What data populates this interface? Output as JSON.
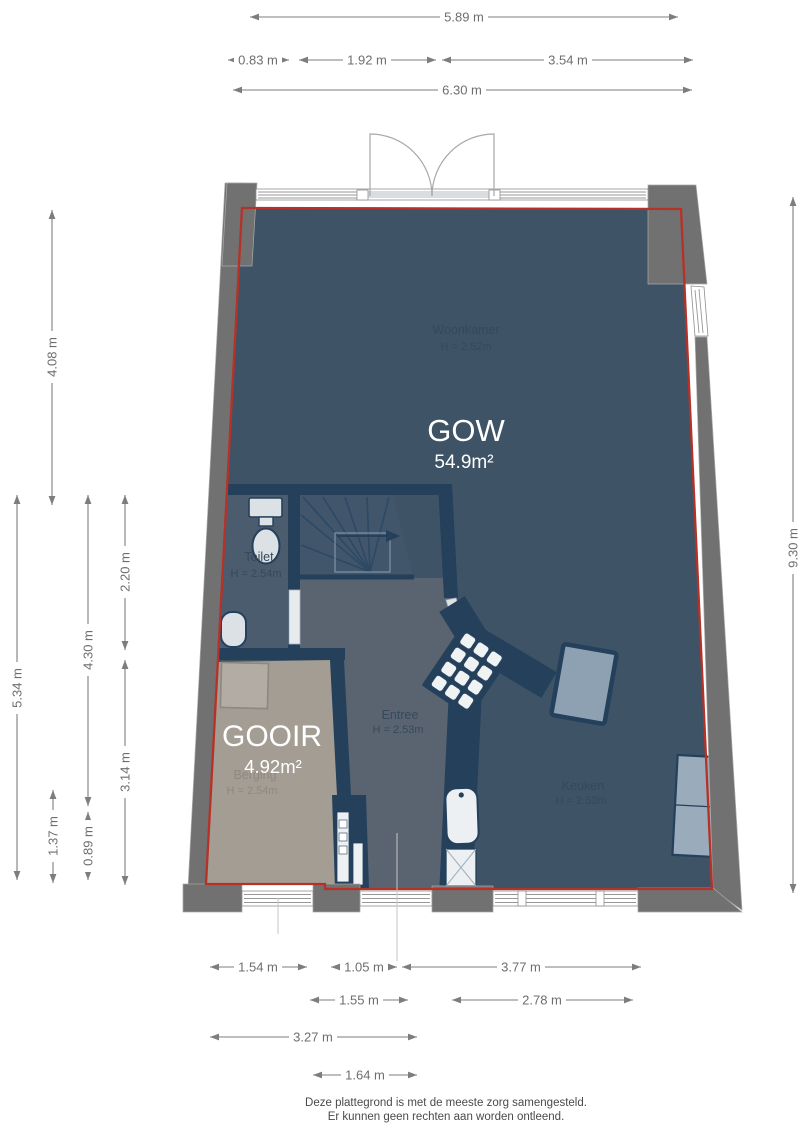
{
  "floorplan": {
    "rooms": {
      "woonkamer": {
        "name": "Woonkamer",
        "ceiling": "H = 2.52m"
      },
      "toilet": {
        "name": "Toilet",
        "ceiling": "H = 2.54m"
      },
      "entree": {
        "name": "Entree",
        "ceiling": "H = 2.53m"
      },
      "keuken": {
        "name": "Keuken",
        "ceiling": "H = 2.53m"
      },
      "berging": {
        "name": "Berging",
        "ceiling": "H = 2.54m"
      },
      "mk": {
        "name": "MK"
      }
    },
    "overlays": {
      "gow": {
        "code": "GOW",
        "area": "54.9m²"
      },
      "gooir": {
        "code": "GOOIR",
        "area": "4.92m²"
      }
    }
  },
  "dimensions": {
    "top": [
      {
        "label": "5.89 m"
      },
      {
        "label": "0.83 m"
      },
      {
        "label": "1.92 m"
      },
      {
        "label": "3.54 m"
      },
      {
        "label": "6.30 m"
      }
    ],
    "left": [
      {
        "label": "4.08 m"
      },
      {
        "label": "2.20 m"
      },
      {
        "label": "4.30 m"
      },
      {
        "label": "5.34 m"
      },
      {
        "label": "3.14 m"
      },
      {
        "label": "1.37 m"
      },
      {
        "label": "0.89 m"
      }
    ],
    "right": [
      {
        "label": "9.30 m"
      }
    ],
    "bottom": [
      {
        "label": "1.54 m"
      },
      {
        "label": "1.05 m"
      },
      {
        "label": "3.77 m"
      },
      {
        "label": "1.55 m"
      },
      {
        "label": "2.78 m"
      },
      {
        "label": "3.27 m"
      },
      {
        "label": "1.64 m"
      }
    ]
  },
  "footer": {
    "line1": "Deze plattegrond is met de meeste zorg samengesteld.",
    "line2": "Er kunnen geen rechten aan worden ontleend."
  },
  "colors": {
    "outline_red": "#b63127",
    "wall_gray": "#717171",
    "interior_blue": "#3e5366",
    "entree_gray": "#5a6470",
    "toilet_blue": "#4a5c6e",
    "stairs_blue": "#41566b",
    "berging_beige": "#a39d94",
    "inner_wall_navy": "#24405b",
    "dimension_gray": "#7d7d7d"
  }
}
